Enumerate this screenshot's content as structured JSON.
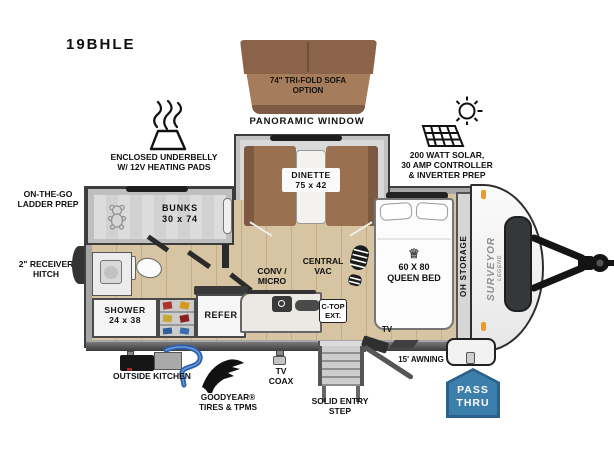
{
  "model": "19BHLE",
  "labels": {
    "sofa_option": "74\" TRI-FOLD SOFA\nOPTION",
    "panoramic_window": "PANORAMIC WINDOW",
    "underbelly": "ENCLOSED UNDERBELLY\nW/ 12V HEATING PADS",
    "solar": "200 WATT SOLAR,\n30 AMP CONTROLLER\n& INVERTER PREP",
    "ladder_prep": "ON-THE-GO\nLADDER PREP",
    "receiver_hitch": "2\" RECEIVER\nHITCH",
    "bunks": "BUNKS\n30 x 74",
    "dinette": "DINETTE\n75 x 42",
    "shower": "SHOWER\n24 x 38",
    "refer": "REFER",
    "conv_micro": "CONV /\nMICRO",
    "central_vac": "CENTRAL\nVAC",
    "ctop_ext": "C-TOP\nEXT.",
    "queen_bed": "60 X 80\nQUEEN BED",
    "oh_storage": "OH STORAGE",
    "tv": "TV",
    "tv_coax": "TV\nCOAX",
    "outside_kitchen": "OUTSIDE KITCHEN",
    "goodyear": "GOODYEAR®\nTIRES & TPMS",
    "solid_entry_step": "SOLID ENTRY\nSTEP",
    "awning": "15' AWNING",
    "pass_thru": "PASS\nTHRU",
    "brand_primary": "SURVEYOR",
    "brand_secondary": "LEGEND"
  },
  "icons": {
    "crown": "♕"
  },
  "colors": {
    "badge-blue": "#3c7fad",
    "badge-blue-dark": "#2b618a",
    "sofa-brown": "#a57c5c",
    "sofa-brown-dark": "#8a6348",
    "sofa-base": "#7d5a43",
    "bench-brown": "#9a7150",
    "bench-brown-dark": "#7c5940",
    "floor-wood": "#d6c4a2",
    "floor-wood-line": "#c3ae88",
    "wall-gray": "#a6a6a6",
    "outline-dark": "#3f3f3f",
    "amber": "#ef9b1d",
    "hose-blue": "#2b5fb0",
    "ink": "#111111"
  }
}
